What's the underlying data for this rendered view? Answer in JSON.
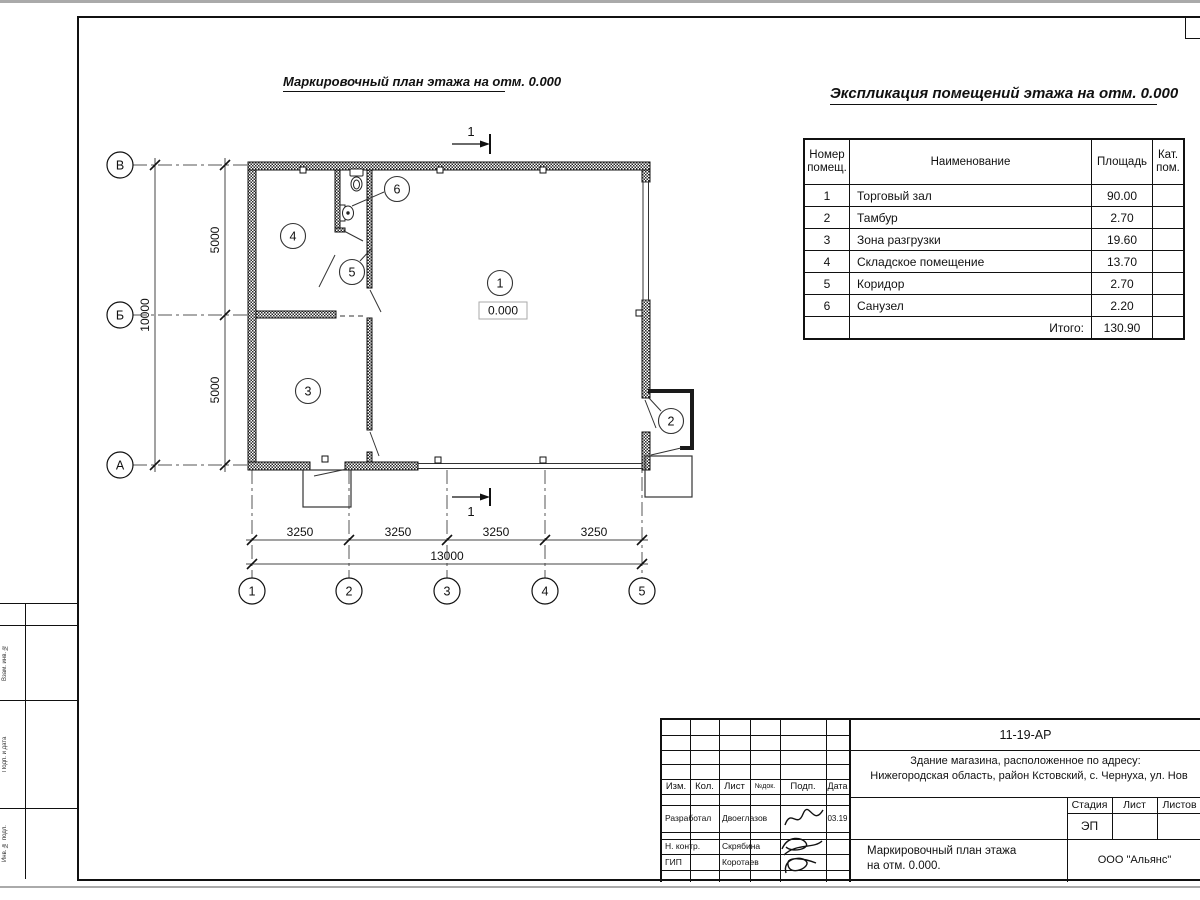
{
  "plan_title": "Маркировочный план этажа на отм. 0.000",
  "explication": {
    "title": "Экспликация помещений этажа на отм. 0.000",
    "headers": {
      "number_l1": "Номер",
      "number_l2": "помещ.",
      "name": "Наименование",
      "area": "Площадь",
      "cat_l1": "Кат.",
      "cat_l2": "пом."
    },
    "rows": [
      {
        "num": "1",
        "name": "Торговый зал",
        "area": "90.00",
        "cat": ""
      },
      {
        "num": "2",
        "name": "Тамбур",
        "area": "2.70",
        "cat": ""
      },
      {
        "num": "3",
        "name": "Зона разгрузки",
        "area": "19.60",
        "cat": ""
      },
      {
        "num": "4",
        "name": "Складское помещение",
        "area": "13.70",
        "cat": ""
      },
      {
        "num": "5",
        "name": "Коридор",
        "area": "2.70",
        "cat": ""
      },
      {
        "num": "6",
        "name": "Санузел",
        "area": "2.20",
        "cat": ""
      }
    ],
    "total_label": "Итого:",
    "total": "130.90"
  },
  "plan": {
    "row_axes": [
      "В",
      "Б",
      "А"
    ],
    "col_axes": [
      "1",
      "2",
      "3",
      "4",
      "5"
    ],
    "dim_left_total": "10000",
    "dim_left_spans": [
      "5000",
      "5000"
    ],
    "dim_bottom_spans": [
      "3250",
      "3250",
      "3250",
      "3250"
    ],
    "dim_bottom_total": "13000",
    "rooms": [
      "1",
      "2",
      "3",
      "4",
      "5",
      "6"
    ],
    "level_mark": "0.000",
    "section_mark": "1"
  },
  "margin_labels": [
    "Взам. инв. №",
    "Подп. и дата",
    "Инв. № подл."
  ],
  "title_block": {
    "doc_number": "11-19-АР",
    "object_address_line1": "Здание магазина, расположенное по адресу:",
    "object_address_line2": "Нижегородская область, район Кстовский, с. Чернуха, ул. Нов",
    "header_cols": [
      "Изм.",
      "Кол.",
      "Лист",
      "№док.",
      "Подп.",
      "Дата"
    ],
    "signature_rows": [
      {
        "role": "Разработал",
        "name": "Двоеглазов",
        "date": "03.19"
      },
      {
        "role": "Н. контр.",
        "name": "Скрябина",
        "date": ""
      },
      {
        "role": "ГИП",
        "name": "Коротаев",
        "date": ""
      }
    ],
    "stage_label": "Стадия",
    "sheet_label": "Лист",
    "sheets_label": "Листов",
    "stage_value": "ЭП",
    "sheet_title_line1": "Маркировочный план этажа",
    "sheet_title_line2": "на отм. 0.000.",
    "company": "ООО \"Альянс\""
  }
}
